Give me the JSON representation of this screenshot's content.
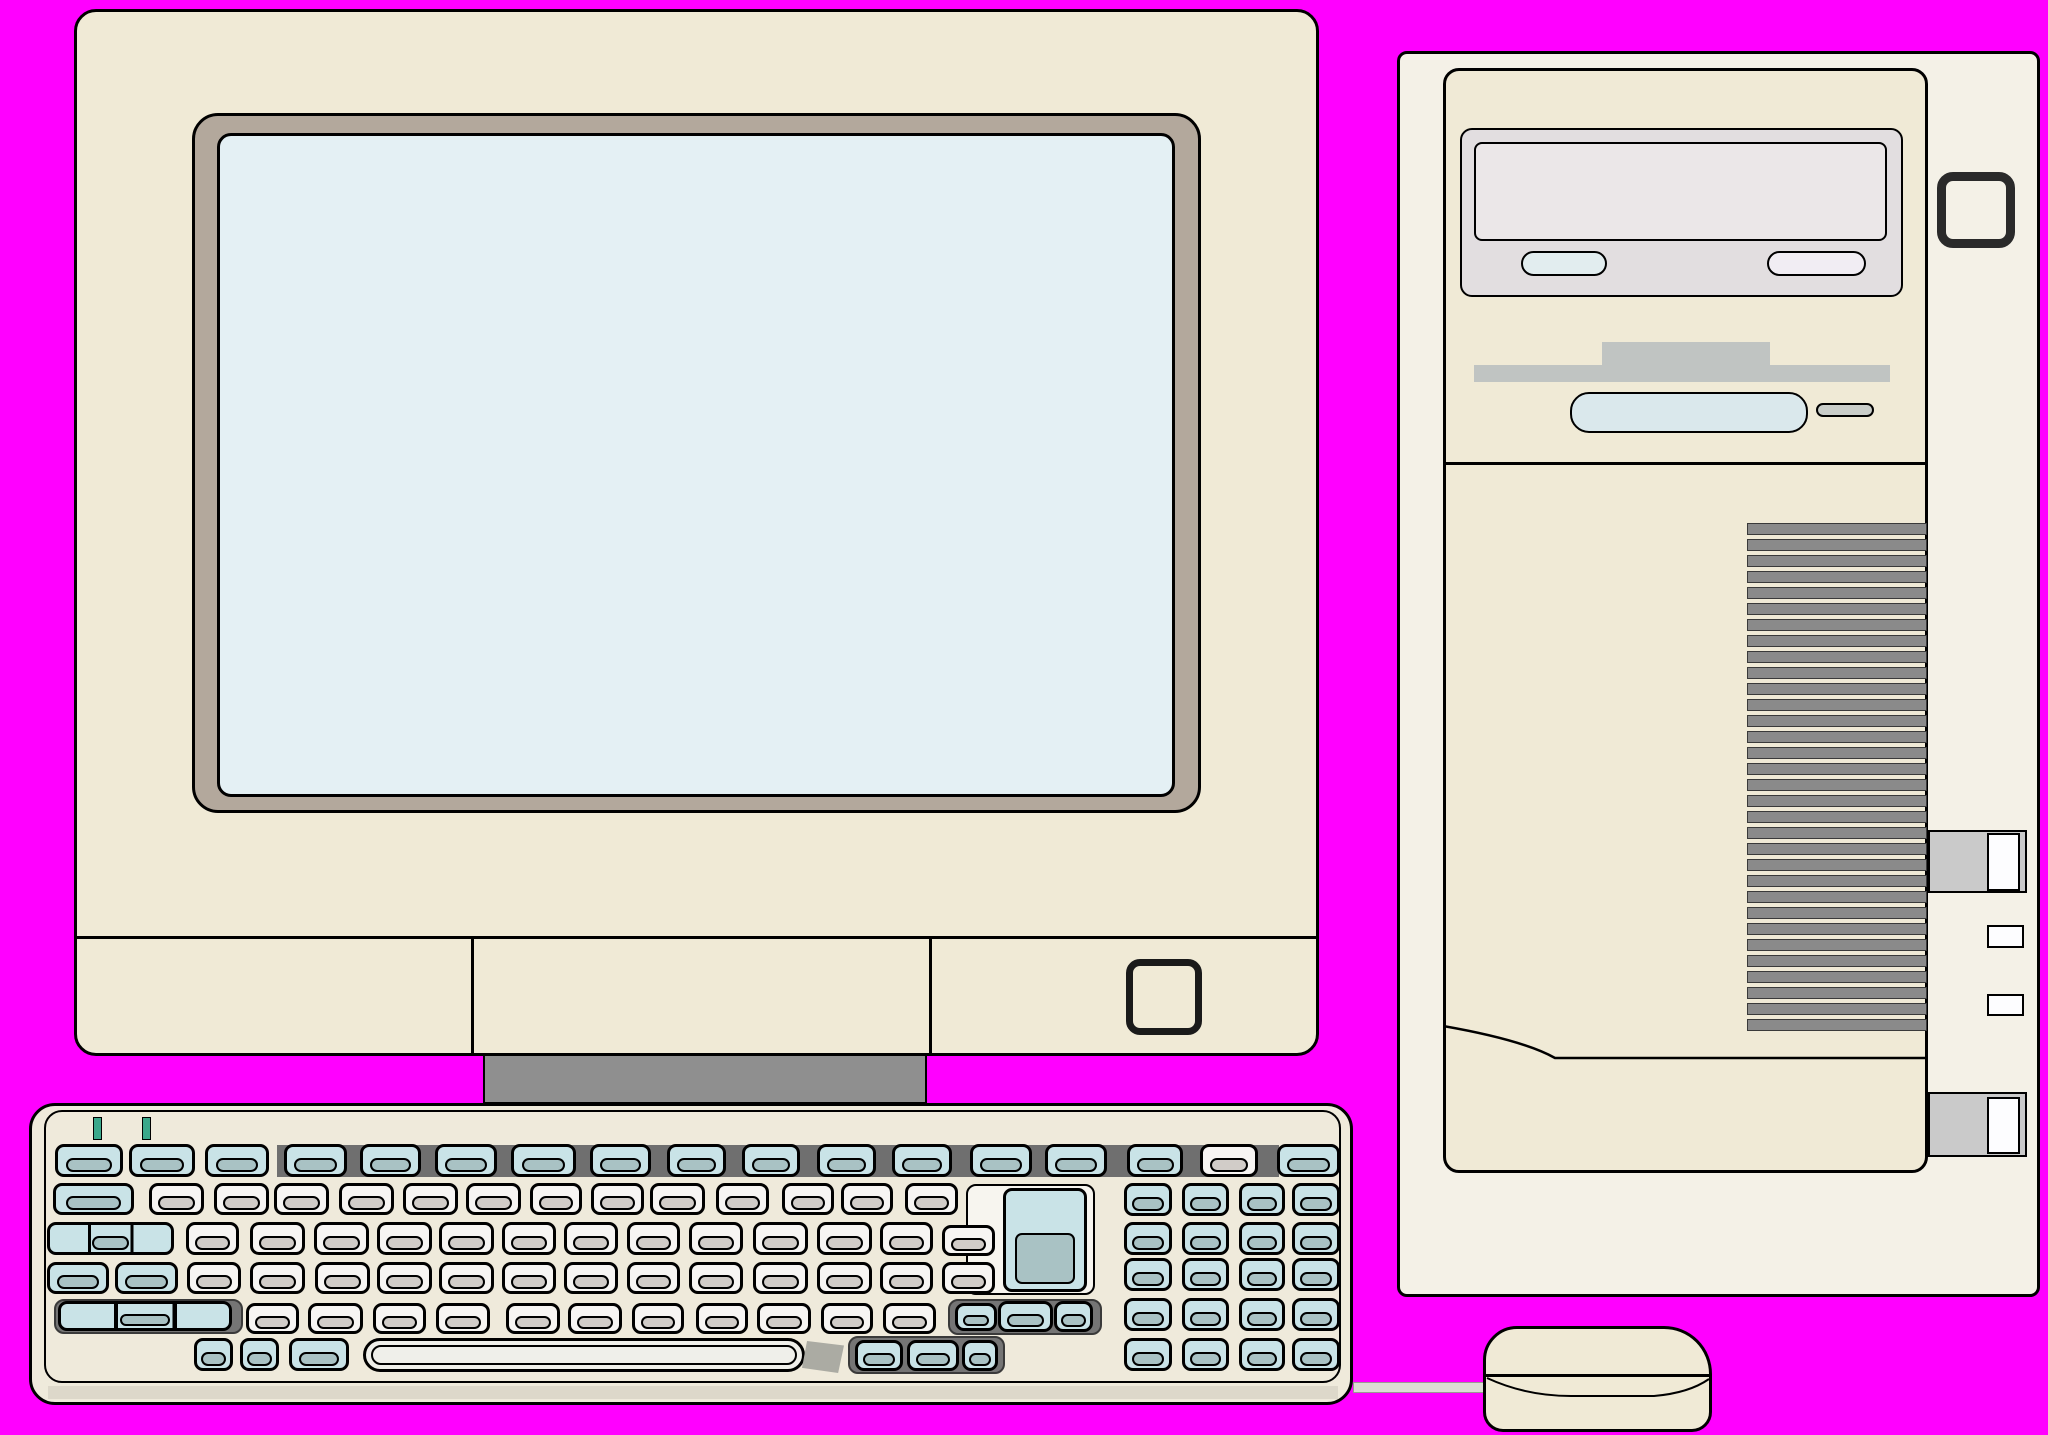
{
  "scene": {
    "title": "Beige desktop computer clipart: CRT monitor, tower case, keyboard and mouse on magenta background",
    "background": "#FF00FF"
  },
  "palette": {
    "bg": "#FF00FF",
    "ink": "#000000",
    "cream": "#F0EAD6",
    "cream2": "#F4F1E7",
    "kb": "#EFEADB",
    "bezel": "#B3A89C",
    "screen": "#E4F0F4",
    "stand": "#8F8F8F",
    "dark-band": "#6F6F6F",
    "vent": "#8A8A8A",
    "cd-bezel": "#E2DEE0",
    "cd-tray": "#EBE7E8",
    "btn-blue": "#E2EDEF",
    "btn-pink": "#F1EDF3",
    "floppy-gray": "#C0C4C2",
    "slot-blue": "#DAE8EC",
    "eject-gray": "#C9CDC9",
    "tab-gray": "#CACACA",
    "white": "#FDFDFF",
    "key-gray-top": "#F7F5F3",
    "key-gray-front": "#D1CCC8",
    "key-blue-top": "#C9E3E7",
    "key-blue-front": "#A9C2C4",
    "led": "#3AA88B",
    "space": "#EFEFEA",
    "wedge": "#ABABA3",
    "pad-dark": "#757575",
    "pad-white": "#F7F5EF",
    "cable": "#DCDCD4"
  },
  "monitor": {
    "parts": [
      "body",
      "screen-bezel",
      "screen",
      "control-strip",
      "power-button",
      "stand"
    ],
    "control_strip_divider_x": [
      472,
      930
    ]
  },
  "tower": {
    "parts": [
      "case",
      "front-panel",
      "cd-drive",
      "cd-tray",
      "cd-button-left",
      "cd-button-right",
      "floppy-drive",
      "floppy-slot",
      "floppy-eject-button",
      "vent-grille",
      "power-button",
      "side-switch-upper",
      "side-switch-lower",
      "side-port-upper",
      "side-port-lower"
    ],
    "vents": {
      "x": 1747,
      "y": 523,
      "w": 180,
      "h": 12,
      "pitch": 16,
      "count": 32
    },
    "tabs": [
      {
        "x": 1928,
        "y": 830,
        "w": 99,
        "h": 63,
        "slot": [
          1987,
          833,
          33,
          58
        ]
      },
      {
        "x": 1928,
        "y": 1092,
        "w": 99,
        "h": 65,
        "slot": [
          1987,
          1097,
          33,
          57
        ]
      }
    ],
    "squares": [
      [
        1987,
        925,
        37,
        23
      ],
      [
        1987,
        994,
        37,
        22
      ]
    ]
  },
  "keyboard": {
    "led_count": 2,
    "leds": [
      [
        93,
        1117
      ],
      [
        142,
        1117
      ]
    ],
    "pads_dark": [
      [
        54,
        1299,
        189,
        35
      ],
      [
        948,
        1299,
        154,
        36
      ],
      [
        848,
        1336,
        157,
        38
      ]
    ],
    "pads_white": [
      [
        966,
        1184,
        129,
        111
      ]
    ],
    "keys": [
      [
        55,
        1144,
        68,
        33,
        "b"
      ],
      [
        129,
        1144,
        66,
        33,
        "b"
      ],
      [
        205,
        1144,
        64,
        33,
        "b"
      ],
      [
        284,
        1144,
        63,
        33,
        "b"
      ],
      [
        360,
        1144,
        61,
        33,
        "b"
      ],
      [
        435,
        1144,
        62,
        33,
        "b"
      ],
      [
        511,
        1144,
        65,
        33,
        "b"
      ],
      [
        590,
        1144,
        61,
        33,
        "b"
      ],
      [
        667,
        1144,
        59,
        33,
        "b"
      ],
      [
        742,
        1144,
        58,
        33,
        "b"
      ],
      [
        817,
        1144,
        59,
        33,
        "b"
      ],
      [
        892,
        1144,
        60,
        33,
        "b"
      ],
      [
        970,
        1144,
        62,
        33,
        "b"
      ],
      [
        1045,
        1144,
        62,
        33,
        "b"
      ],
      [
        1127,
        1144,
        56,
        33,
        "b"
      ],
      [
        1200,
        1144,
        58,
        33,
        "g"
      ],
      [
        1277,
        1144,
        63,
        33,
        "b"
      ],
      [
        53,
        1183,
        81,
        32,
        "b"
      ],
      [
        149,
        1183,
        55,
        32,
        "g"
      ],
      [
        214,
        1183,
        55,
        32,
        "g"
      ],
      [
        274,
        1183,
        55,
        32,
        "g"
      ],
      [
        339,
        1183,
        55,
        32,
        "g"
      ],
      [
        403,
        1183,
        55,
        32,
        "g"
      ],
      [
        466,
        1183,
        55,
        32,
        "g"
      ],
      [
        530,
        1183,
        52,
        32,
        "g"
      ],
      [
        591,
        1183,
        53,
        32,
        "g"
      ],
      [
        650,
        1183,
        55,
        32,
        "g"
      ],
      [
        716,
        1183,
        53,
        32,
        "g"
      ],
      [
        782,
        1183,
        52,
        32,
        "g"
      ],
      [
        841,
        1183,
        52,
        32,
        "g"
      ],
      [
        905,
        1183,
        53,
        32,
        "g"
      ],
      [
        47,
        1222,
        127,
        33,
        "s3"
      ],
      [
        186,
        1222,
        53,
        33,
        "g"
      ],
      [
        250,
        1222,
        55,
        33,
        "g"
      ],
      [
        314,
        1222,
        55,
        33,
        "g"
      ],
      [
        377,
        1222,
        55,
        33,
        "g"
      ],
      [
        439,
        1222,
        55,
        33,
        "g"
      ],
      [
        502,
        1222,
        54,
        33,
        "g"
      ],
      [
        564,
        1222,
        54,
        33,
        "g"
      ],
      [
        627,
        1222,
        53,
        33,
        "g"
      ],
      [
        689,
        1222,
        54,
        33,
        "g"
      ],
      [
        753,
        1222,
        55,
        33,
        "g"
      ],
      [
        817,
        1222,
        55,
        33,
        "g"
      ],
      [
        880,
        1222,
        53,
        33,
        "g"
      ],
      [
        942,
        1225,
        53,
        31,
        "g"
      ],
      [
        47,
        1262,
        62,
        32,
        "b"
      ],
      [
        115,
        1262,
        63,
        32,
        "b"
      ],
      [
        187,
        1262,
        54,
        32,
        "g"
      ],
      [
        250,
        1262,
        55,
        32,
        "g"
      ],
      [
        315,
        1262,
        55,
        32,
        "g"
      ],
      [
        377,
        1262,
        55,
        32,
        "g"
      ],
      [
        439,
        1262,
        55,
        32,
        "g"
      ],
      [
        502,
        1262,
        54,
        32,
        "g"
      ],
      [
        564,
        1262,
        54,
        32,
        "g"
      ],
      [
        627,
        1262,
        53,
        32,
        "g"
      ],
      [
        689,
        1262,
        54,
        32,
        "g"
      ],
      [
        753,
        1262,
        55,
        32,
        "g"
      ],
      [
        817,
        1262,
        55,
        32,
        "g"
      ],
      [
        880,
        1262,
        53,
        32,
        "g"
      ],
      [
        942,
        1262,
        53,
        32,
        "g"
      ],
      [
        58,
        1301,
        174,
        30,
        "s3"
      ],
      [
        246,
        1303,
        53,
        31,
        "g"
      ],
      [
        308,
        1303,
        55,
        31,
        "g"
      ],
      [
        373,
        1303,
        53,
        31,
        "g"
      ],
      [
        436,
        1303,
        54,
        31,
        "g"
      ],
      [
        506,
        1303,
        54,
        31,
        "g"
      ],
      [
        568,
        1303,
        54,
        31,
        "g"
      ],
      [
        632,
        1303,
        52,
        31,
        "g"
      ],
      [
        696,
        1303,
        52,
        31,
        "g"
      ],
      [
        757,
        1303,
        54,
        31,
        "g"
      ],
      [
        821,
        1303,
        52,
        31,
        "g"
      ],
      [
        883,
        1303,
        53,
        31,
        "g"
      ],
      [
        955,
        1303,
        42,
        28,
        "b"
      ],
      [
        998,
        1301,
        55,
        31,
        "b"
      ],
      [
        1054,
        1301,
        39,
        31,
        "b"
      ],
      [
        194,
        1338,
        39,
        33,
        "b"
      ],
      [
        240,
        1338,
        39,
        33,
        "b"
      ],
      [
        289,
        1338,
        60,
        33,
        "b"
      ],
      [
        855,
        1340,
        48,
        31,
        "b"
      ],
      [
        907,
        1340,
        52,
        31,
        "b"
      ],
      [
        962,
        1340,
        36,
        31,
        "b"
      ],
      [
        1124,
        1183,
        48,
        33,
        "b"
      ],
      [
        1182,
        1183,
        47,
        33,
        "b"
      ],
      [
        1239,
        1183,
        46,
        33,
        "b"
      ],
      [
        1292,
        1183,
        48,
        33,
        "b"
      ],
      [
        1124,
        1222,
        48,
        33,
        "b"
      ],
      [
        1182,
        1222,
        47,
        33,
        "b"
      ],
      [
        1239,
        1222,
        46,
        33,
        "b"
      ],
      [
        1292,
        1222,
        48,
        33,
        "b"
      ],
      [
        1124,
        1258,
        48,
        33,
        "b"
      ],
      [
        1182,
        1258,
        47,
        33,
        "b"
      ],
      [
        1239,
        1258,
        46,
        33,
        "b"
      ],
      [
        1292,
        1258,
        48,
        33,
        "b"
      ],
      [
        1124,
        1298,
        48,
        33,
        "b"
      ],
      [
        1182,
        1298,
        47,
        33,
        "b"
      ],
      [
        1239,
        1298,
        46,
        33,
        "b"
      ],
      [
        1292,
        1298,
        48,
        33,
        "b"
      ],
      [
        1124,
        1338,
        48,
        33,
        "b"
      ],
      [
        1182,
        1338,
        47,
        33,
        "b"
      ],
      [
        1239,
        1338,
        46,
        33,
        "b"
      ],
      [
        1292,
        1338,
        48,
        33,
        "b"
      ],
      [
        1003,
        1188,
        84,
        104,
        "tall"
      ]
    ]
  },
  "mouse": {
    "parts": [
      "body",
      "button-divider",
      "cable"
    ]
  }
}
